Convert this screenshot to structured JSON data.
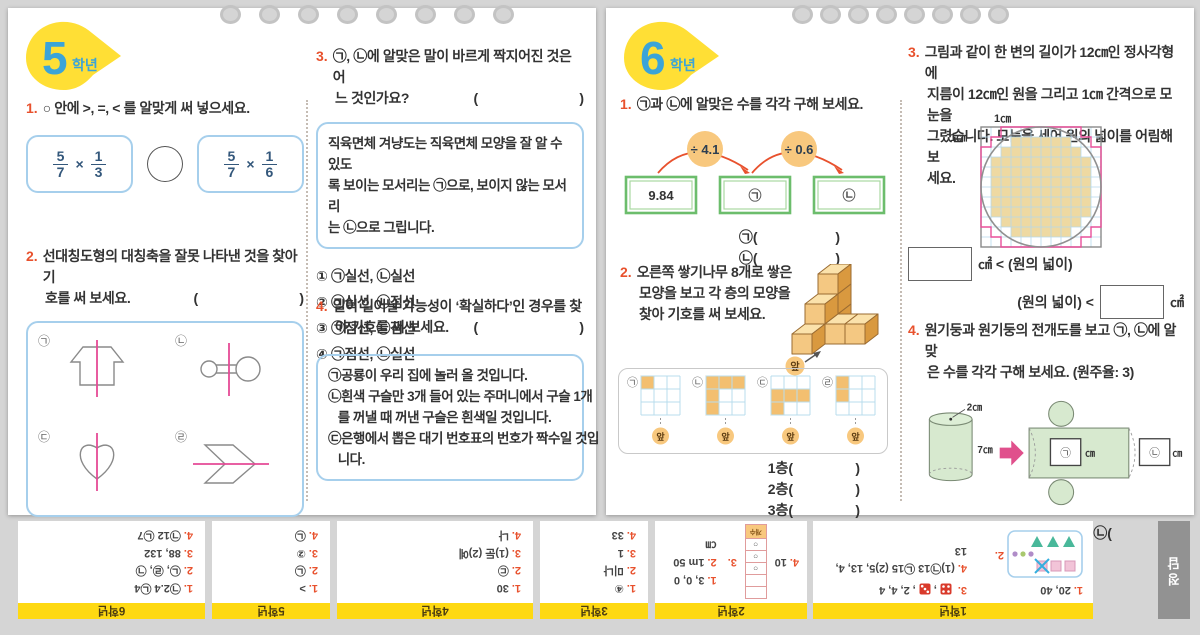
{
  "page5": {
    "badge_number": "5",
    "badge_suffix": "학년",
    "q1": {
      "no": "1.",
      "lines": [
        "○ 안에 >, =, < 를 알맞게 써 넣으세요."
      ],
      "frac_left": {
        "n1": "5",
        "d1": "7",
        "op": "×",
        "n2": "1",
        "d2": "3"
      },
      "frac_right": {
        "n1": "5",
        "d1": "7",
        "op": "×",
        "n2": "1",
        "d2": "6"
      }
    },
    "q2": {
      "no": "2.",
      "lines": [
        "선대칭도형의 대칭축을 잘못 나타낸 것을 찾아 기",
        "호를 써 보세요."
      ],
      "paren": "(                          )",
      "labels": [
        "㉠",
        "㉡",
        "㉢",
        "㉣"
      ]
    },
    "q3": {
      "no": "3.",
      "lines": [
        "㉠, ㉡에 알맞은 말이 바르게 짝지어진 것은 어",
        "느 것인가요?"
      ],
      "paren": "(                          )",
      "box_lines": [
        "직육면체 겨냥도는 직육면체 모양을 잘 알 수 있도",
        "록 보이는 모서리는 ㉠으로, 보이지 않는 모서리",
        "는 ㉡으로 그립니다."
      ],
      "options": [
        "① ㉠실선, ㉡실선",
        "② ㉠실선, ㉡점선",
        "③ ㉠점선, ㉡점선",
        "④ ㉠점선, ㉡실선"
      ]
    },
    "q4": {
      "no": "4.",
      "lines": [
        "일이 일어날 가능성이 ‘확실하다’인 경우를 찾",
        "아 기호를 써 보세요."
      ],
      "paren": "(                          )",
      "box_lines": [
        "㉠공룡이 우리 집에 놀러 올 것입니다.",
        "㉡흰색 구슬만 3개 들어 있는 주머니에서 구슬 1개",
        "   를 꺼낼 때 꺼낸 구슬은 흰색일 것입니다.",
        "㉢은행에서 뽑은 대기 번호표의 번호가 짝수일 것입",
        "   니다."
      ]
    }
  },
  "page6": {
    "badge_number": "6",
    "badge_suffix": "학년",
    "q1": {
      "no": "1.",
      "lines": [
        "㉠과 ㉡에 알맞은 수를 각각 구해 보세요."
      ],
      "start": "9.84",
      "op1": "÷ 4.1",
      "op2": "÷ 0.6",
      "mid": "㉠",
      "end": "㉡",
      "ans1": "㉠(                    )",
      "ans2": "㉡(                    )"
    },
    "q2": {
      "no": "2.",
      "lines": [
        "오른쪽 쌓기나무 8개로 쌓은",
        "모양을 보고 각 층의 모양을",
        "찾아 기호를 써 보세요."
      ],
      "front": "앞",
      "grids": [
        {
          "label": "㉠",
          "cells": [
            [
              0,
              0
            ]
          ]
        },
        {
          "label": "㉡",
          "cells": [
            [
              0,
              0
            ],
            [
              1,
              0
            ],
            [
              2,
              0
            ],
            [
              0,
              1
            ],
            [
              0,
              2
            ]
          ]
        },
        {
          "label": "㉢",
          "cells": [
            [
              0,
              1
            ],
            [
              1,
              1
            ],
            [
              2,
              1
            ],
            [
              0,
              2
            ]
          ]
        },
        {
          "label": "㉣",
          "cells": [
            [
              0,
              0
            ],
            [
              0,
              1
            ]
          ]
        }
      ],
      "answers": [
        "1층(                )",
        "2층(                )",
        "3층(                )"
      ]
    },
    "q3": {
      "no": "3.",
      "lines": [
        "그림과 같이 한 변의 길이가 12㎝인 정사각형에",
        "지름이 12㎝인 원을 그리고 1㎝ 간격으로 모눈을",
        "그렸습니다. 모눈을 세어 원의 넓이를 어림해 보",
        "세요."
      ],
      "cm_top": "1㎝",
      "cm_left": "1㎝",
      "cmp1": "㎠ < (원의 넓이)",
      "cmp2a": "(원의 넓이) <",
      "cmp2b": "㎠",
      "tan_rows": [
        [
          1,
          3,
          6
        ],
        [
          2,
          2,
          8
        ],
        [
          3,
          1,
          10
        ],
        [
          4,
          1,
          10
        ],
        [
          5,
          1,
          10
        ],
        [
          6,
          1,
          10
        ],
        [
          7,
          1,
          10
        ],
        [
          8,
          1,
          10
        ],
        [
          9,
          2,
          8
        ],
        [
          10,
          3,
          6
        ]
      ],
      "ring": [
        [
          2,
          0
        ],
        [
          10,
          0
        ],
        [
          10,
          1
        ],
        [
          11,
          1
        ],
        [
          11,
          2
        ],
        [
          12,
          2
        ],
        [
          12,
          10
        ],
        [
          11,
          10
        ],
        [
          11,
          11
        ],
        [
          10,
          11
        ],
        [
          10,
          12
        ],
        [
          2,
          12
        ],
        [
          2,
          11
        ],
        [
          1,
          11
        ],
        [
          1,
          10
        ],
        [
          0,
          10
        ],
        [
          0,
          2
        ],
        [
          1,
          2
        ],
        [
          1,
          1
        ],
        [
          2,
          1
        ]
      ]
    },
    "q4": {
      "no": "4.",
      "lines": [
        "원기둥과 원기둥의 전개도를 보고 ㉠, ㉡에 알맞",
        "은 수를 각각 구해 보세요. (원주율: 3)"
      ],
      "r_label": "2㎝",
      "h_label": "7㎝",
      "boxA": "㉠",
      "boxB": "㉡",
      "unitA": "㎝",
      "unitB": "㎝",
      "ans": "㉠(              )  ㉡(              )"
    }
  },
  "answer_key": {
    "tab": "정답",
    "dice": [
      4,
      3
    ],
    "table": {
      "header": "개수",
      "rows": [
        "",
        "",
        "○",
        "○",
        "○"
      ]
    },
    "sections": [
      {
        "grade": "6학년",
        "lines": [
          {
            "no": "1.",
            "text": "㉠2.4 ㉡4"
          },
          {
            "no": "2.",
            "text": "㉡, ㉣, ㉠"
          },
          {
            "no": "3.",
            "text": "88, 132"
          },
          {
            "no": "4.",
            "text": "㉠12 ㉡7"
          }
        ]
      },
      {
        "grade": "5학년",
        "lines": [
          {
            "no": "1.",
            "text": ">"
          },
          {
            "no": "2.",
            "text": "㉡"
          },
          {
            "no": "3.",
            "text": "②"
          },
          {
            "no": "4.",
            "text": "㉡"
          }
        ]
      },
      {
        "grade": "4학년",
        "lines": [
          {
            "no": "1.",
            "text": "30"
          },
          {
            "no": "2.",
            "text": "㉢"
          },
          {
            "no": "3.",
            "text": "(1)둔 (2)예"
          },
          {
            "no": "4.",
            "text": "나"
          }
        ]
      },
      {
        "grade": "3학년",
        "lines": [
          {
            "no": "1.",
            "text": "④"
          },
          {
            "no": "2.",
            "text": "미나"
          },
          {
            "no": "3.",
            "text": "1"
          },
          {
            "no": "4.",
            "text": "33"
          }
        ]
      },
      {
        "grade": "2학년",
        "lines": [
          {
            "no": "1.",
            "text": "3, 0, 0"
          },
          {
            "no": "2.",
            "text": "1m 50㎝"
          },
          {
            "no": "3.",
            "text": ""
          },
          {
            "no": "4.",
            "text": "10"
          }
        ]
      },
      {
        "grade": "1학년",
        "lines": [
          {
            "no": "1.",
            "text": "20, 40"
          },
          {
            "no": "2.",
            "text": ""
          },
          {
            "no": "3.",
            "text": "2, 4, 4"
          },
          {
            "no": "4.",
            "text": "(1)㉠13 ㉡15 (2)5, 13, 4, 13"
          }
        ]
      }
    ]
  }
}
